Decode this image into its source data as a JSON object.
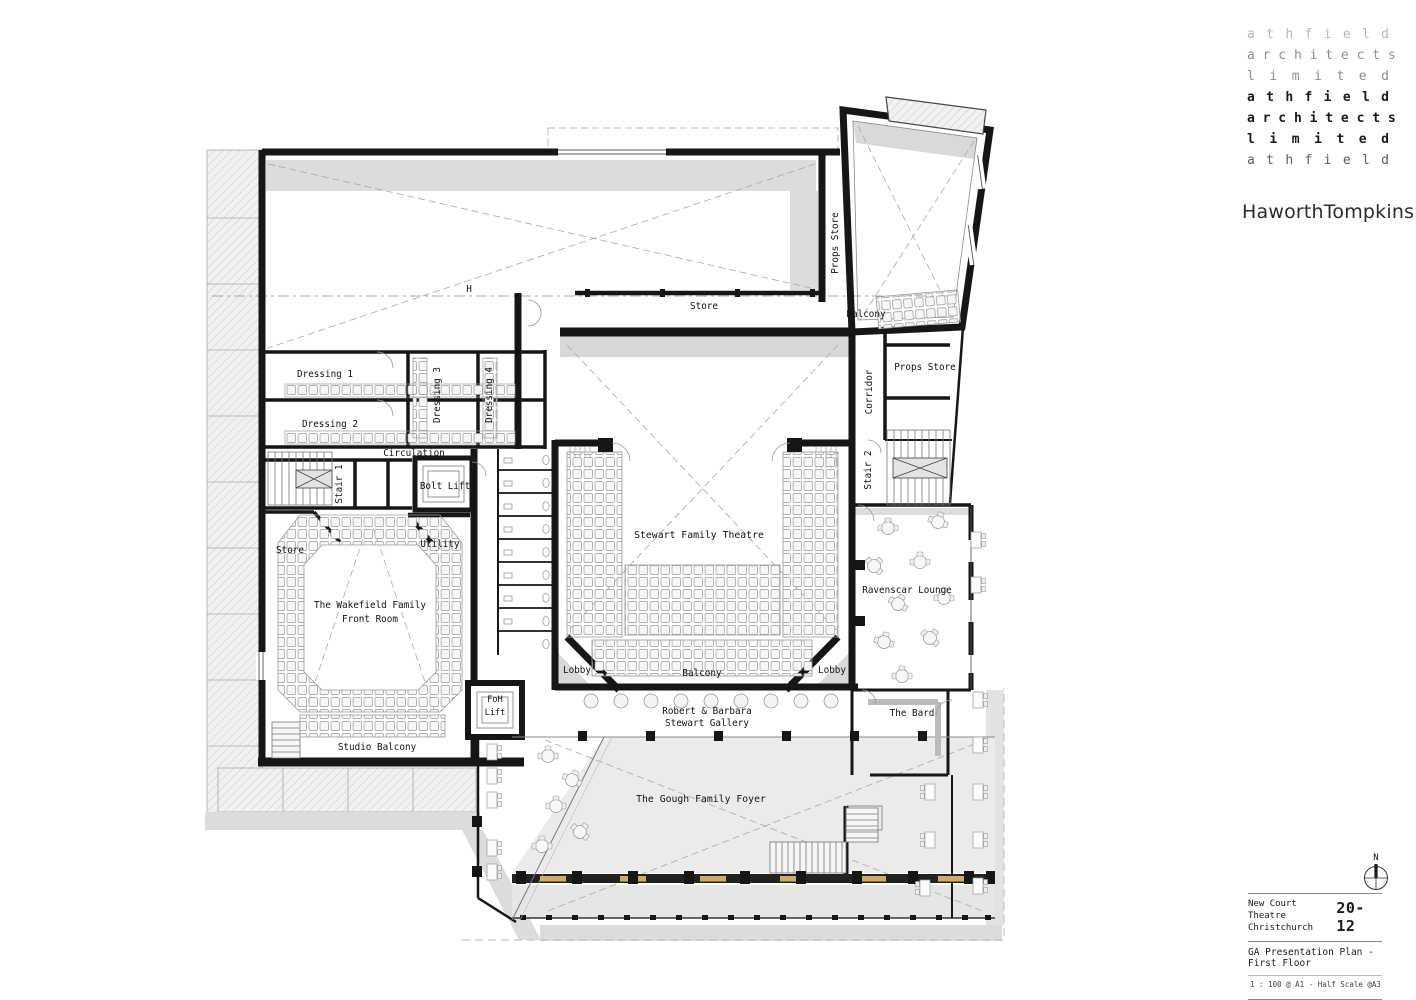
{
  "branding": {
    "firm_lines": [
      "a t h f i e l d",
      "a r c h i t e c t s",
      "l i m i t e d",
      "a t h f i e l d",
      "a r c h i t e c t s",
      "l i m i t e d",
      "a t h f i e l d"
    ],
    "studio_name": "HaworthTompkins"
  },
  "north_arrow": {
    "label": "N"
  },
  "title_block": {
    "project_line1": "New Court Theatre",
    "project_line2": "Christchurch",
    "project_number": "20-12",
    "drawing_title": "GA Presentation Plan - First Floor",
    "scale_note": "1 : 100 @ A1 - Half Scale @A3"
  },
  "plan": {
    "labels": {
      "dressing1": "Dressing 1",
      "dressing2": "Dressing 2",
      "dressing3": "Dressing 3",
      "dressing4": "Dressing 4",
      "circulation": "Circulation",
      "stair1": "Stair 1",
      "bolt_lift": "Bolt Lift",
      "store_west": "Store",
      "utility": "Utility",
      "wakefield1": "The Wakefield Family",
      "wakefield2": "Front Room",
      "studio_balcony": "Studio Balcony",
      "foh1": "FoH",
      "foh2": "Lift",
      "theatre": "Stewart Family Theatre",
      "lobby_left": "Lobby",
      "lobby_right": "Lobby",
      "balcony_theatre": "Balcony",
      "gallery1": "Robert & Barbara",
      "gallery2": "Stewart Gallery",
      "gough_foyer": "The Gough Family Foyer",
      "ravenscar": "Ravenscar Lounge",
      "the_bard": "The Bard",
      "stair2": "Stair 2",
      "props_store_tower": "Props Store",
      "balcony_upper": "Balcony",
      "corridor": "Corridor",
      "props_store_east": "Props Store",
      "store_north": "Store",
      "datum": "H"
    },
    "colors": {
      "wall": "#161616",
      "shade": "#dcdcdc",
      "timber": "#ccaa70"
    }
  }
}
